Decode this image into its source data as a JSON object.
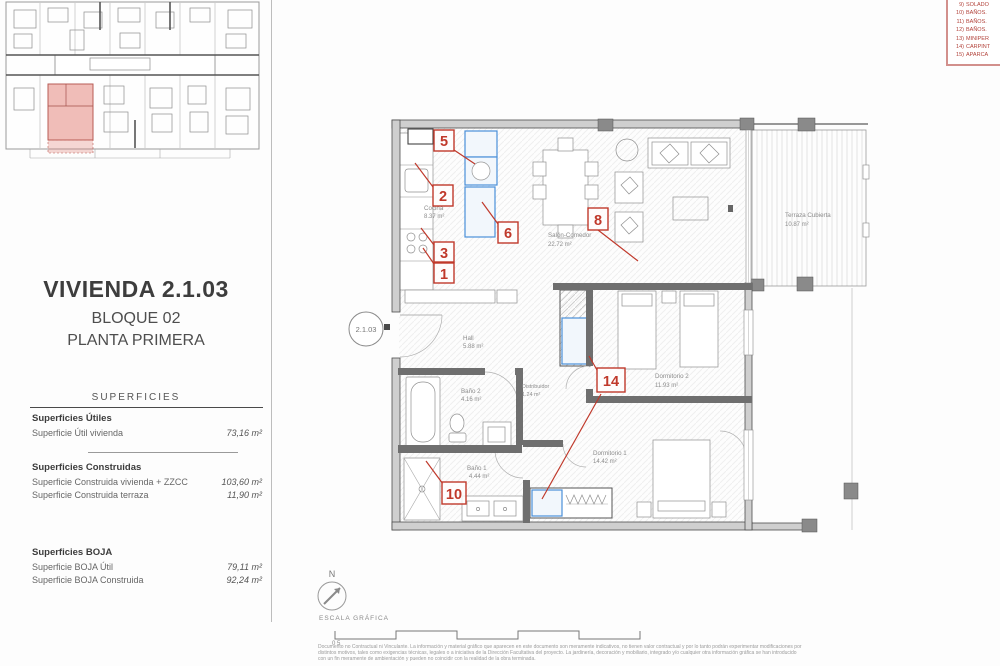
{
  "unit": {
    "title": "VIVIENDA 2.1.03",
    "block": "BLOQUE 02",
    "floor": "PLANTA PRIMERA"
  },
  "surfaces": {
    "header": "SUPERFICIES",
    "groups": [
      {
        "title": "Superficies Útiles",
        "rows": [
          {
            "label": "Superficie Útil vivienda",
            "value": "73,16 m²"
          }
        ]
      },
      {
        "title": "Superficies Construidas",
        "rows": [
          {
            "label": "Superficie Construida vivienda + ZZCC",
            "value": "103,60 m²"
          },
          {
            "label": "Superficie Construida terraza",
            "value": "11,90 m²"
          }
        ]
      },
      {
        "title": "Superficies BOJA",
        "rows": [
          {
            "label": "Superficie BOJA Útil",
            "value": "79,11 m²"
          },
          {
            "label": "Superficie BOJA Construida",
            "value": "92,24 m²"
          }
        ]
      }
    ]
  },
  "legend": {
    "items": [
      {
        "num": "9)",
        "label": "SOLADO"
      },
      {
        "num": "10)",
        "label": "BAÑOS."
      },
      {
        "num": "11)",
        "label": "BAÑOS."
      },
      {
        "num": "12)",
        "label": "BAÑOS."
      },
      {
        "num": "13)",
        "label": "MINIPER"
      },
      {
        "num": "14)",
        "label": "CARPINT"
      },
      {
        "num": "15)",
        "label": "APARCA"
      }
    ]
  },
  "plan": {
    "unit_bubble": "2.1.03",
    "rooms": {
      "cocina": {
        "name": "Cocina",
        "area": "8.37 m²"
      },
      "salon": {
        "name": "Salón-Comedor",
        "area": "22.72 m²"
      },
      "terraza": {
        "name": "Terraza Cubierta",
        "area": "10.87 m²"
      },
      "hall": {
        "name": "Hall",
        "area": "5.88 m²"
      },
      "distribuidor": {
        "name": "Distribuidor",
        "area": "1.24 m²"
      },
      "bano2": {
        "name": "Baño 2",
        "area": "4.16 m²"
      },
      "bano1": {
        "name": "Baño 1",
        "area": "4.44 m²"
      },
      "dorm2": {
        "name": "Dormitorio 2",
        "area": "11.93 m²"
      },
      "dorm1": {
        "name": "Dormitorio 1",
        "area": "14.42 m²"
      }
    },
    "markers": [
      "1",
      "2",
      "3",
      "5",
      "6",
      "8",
      "10",
      "14"
    ]
  },
  "compass": {
    "north": "N",
    "scale_label": "ESCALA GRÁFICA",
    "scale_zero": "0 5"
  },
  "footer": {
    "line1": "Documento no Contractual ni Vinculante. La información y material gráfico que aparecen en este documento son meramente indicativos, no tienen valor contractual y por lo tanto podrán experimentar modificaciones por",
    "line2": "distintos motivos, tales como exigencias técnicas, legales o a iniciativa de la Dirección Facultativa del proyecto. La jardinería, decoración y mobiliario, integrado y/o cualquier otra información gráfica se han introducido",
    "line3": "con un fin meramente de ambientación y pueden no coincidir con la realidad de la obra terminada."
  },
  "colors": {
    "annotation_red": "#c0392b",
    "appliance_blue": "#4a90d9",
    "highlight_pink": "#e27b71"
  }
}
